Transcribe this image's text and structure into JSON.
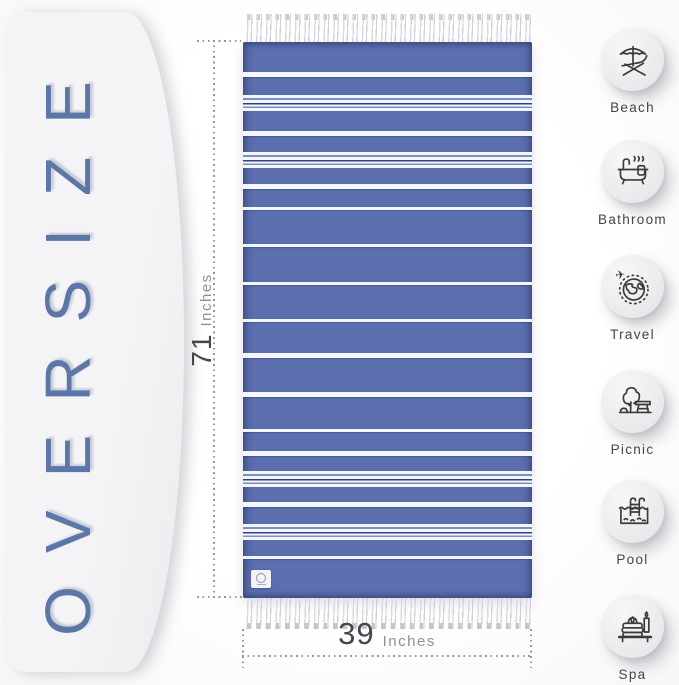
{
  "panel": {
    "label": "OVERSIZE",
    "accent_color": "#5d76a8"
  },
  "dimensions": {
    "height": {
      "value": "71",
      "unit": "Inches"
    },
    "width": {
      "value": "39",
      "unit": "Inches"
    }
  },
  "towel": {
    "base_color": "#5b6eae",
    "stripe_color": "#f3f6fb",
    "stripes": [
      {
        "top": 30,
        "type": "medium"
      },
      {
        "top": 53,
        "type": "group"
      },
      {
        "top": 89,
        "type": "medium"
      },
      {
        "top": 110,
        "type": "group"
      },
      {
        "top": 142,
        "type": "medium"
      },
      {
        "top": 165,
        "type": "thin"
      },
      {
        "top": 202,
        "type": "thin"
      },
      {
        "top": 240,
        "type": "thin"
      },
      {
        "top": 277,
        "type": "thin"
      },
      {
        "top": 311,
        "type": "medium"
      },
      {
        "top": 350,
        "type": "medium"
      },
      {
        "top": 387,
        "type": "thin"
      },
      {
        "top": 409,
        "type": "medium"
      },
      {
        "top": 429,
        "type": "group"
      },
      {
        "top": 460,
        "type": "medium"
      },
      {
        "top": 482,
        "type": "group"
      },
      {
        "top": 514,
        "type": "thin"
      }
    ]
  },
  "features": {
    "items": [
      {
        "label": "Beach",
        "icon": "beach-icon"
      },
      {
        "label": "Bathroom",
        "icon": "bathroom-icon"
      },
      {
        "label": "Travel",
        "icon": "travel-icon"
      },
      {
        "label": "Picnic",
        "icon": "picnic-icon"
      },
      {
        "label": "Pool",
        "icon": "pool-icon"
      },
      {
        "label": "Spa",
        "icon": "spa-icon"
      }
    ]
  }
}
